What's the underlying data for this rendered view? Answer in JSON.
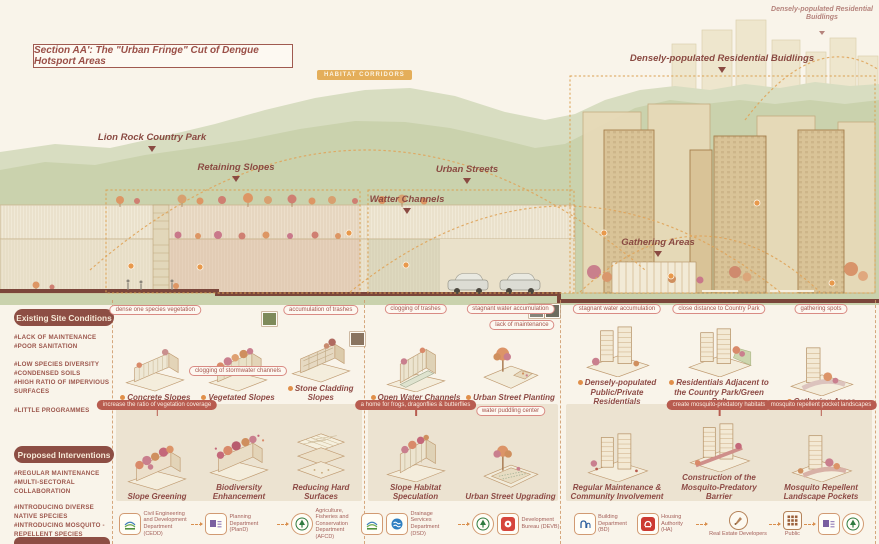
{
  "colors": {
    "maroon": "#8d4a45",
    "accent_orange": "#e4ae5a",
    "badge_fill": "#8d4e44",
    "hill_green": "#c9d1ac",
    "building_tan": "#d9c397"
  },
  "section": {
    "title": "Section AA': The \"Urban Fringe\" Cut of Dengue Hotsport Areas",
    "habitat_badge": "HABITAT CORRIDORS",
    "labels": {
      "lion_rock": "Lion Rock Country Park",
      "retaining_slopes": "Retaining Slopes",
      "urban_streets": "Urban Streets",
      "water_channels": "Watter Channels",
      "residential": "Densely-populated Residential Buidlings",
      "residential_small": "Densely-populated Residential Buidlings",
      "gathering": "Gathering Areas"
    }
  },
  "existing": {
    "header": "Existing Site Conditions",
    "tags": [
      "#LACK OF MAINTENANCE",
      "#POOR SANITATION",
      "#LOW SPECIES DIVERSITY",
      "#CONDENSED SOILS",
      "#HIGH RATIO OF IMPERVIOUS SURFACES",
      "#LITTLE PROGRAMMES"
    ],
    "items": [
      {
        "label": "Concrete Slopes",
        "badge": "dense one species vegetation"
      },
      {
        "label": "Vegetated Slopes",
        "badge": "clogging of stormwater channels"
      },
      {
        "label": "Stone Cladding Slopes",
        "badge": "accumulation of trashes"
      },
      {
        "label": "Open Water Channels",
        "badge": "clogging of trashes"
      },
      {
        "label": "Urban Street Planting",
        "badge": "stagnant water accumulation",
        "badge2": "lack of maintenance"
      },
      {
        "label": "Densely-populated Public/Private Residentials",
        "badge": "stagnant water accumulation"
      },
      {
        "label": "Residentials Adjacent to the Country Park/Green Belt",
        "badge": "close distance to Country Park"
      },
      {
        "label": "Gathering Areas",
        "badge": "gathering spots"
      }
    ]
  },
  "proposed": {
    "header": "Proposed Interventions",
    "tags": [
      "#REGULAR MAINTENANCE",
      "#MULTI-SECTORAL COLLABORATION",
      "#INTRODUCING DIVERSE NATIVE SPECIES",
      "#INTRODUCING MOSQUITO -REPELLENT SPECIES",
      "#PRODUCING MOSQUITO -PREDATORY HABITATS"
    ],
    "items": [
      {
        "label": "Slope Greening",
        "badge": "increase the ratio of vegetation coverage"
      },
      {
        "label": "Biodiversity Enhancement"
      },
      {
        "label": "Reducing Hard Surfaces"
      },
      {
        "label": "Slope Habitat Speculation",
        "badge": "a home for frogs, dragonflies & butterflies"
      },
      {
        "label": "Urban Street Upgrading",
        "badge": "water puddling center"
      },
      {
        "label": "Regular Maintenance & Community Involvement"
      },
      {
        "label": "Construction of the Mosquito-Predatory Barrier",
        "badge": "create mosquito-predatory habitats"
      },
      {
        "label": "Mosquito Repellent Landscape Pockets",
        "badge": "mosquito repellent pocket landscapes"
      }
    ]
  },
  "stakeholders": {
    "p1": [
      "Civil Engineering and Development Department (CEDD)",
      "Planning Department (PlanD)",
      "Agriculture, Fisheries and Conservation Department (AFCD)"
    ],
    "p2": [
      "Drainage Services Department (DSD)",
      "Development Bureau (DEVB)"
    ],
    "p3": [
      "Building Department (BD)",
      "Housing Authority (HA)",
      "Real Estate Developers",
      "Public"
    ]
  }
}
